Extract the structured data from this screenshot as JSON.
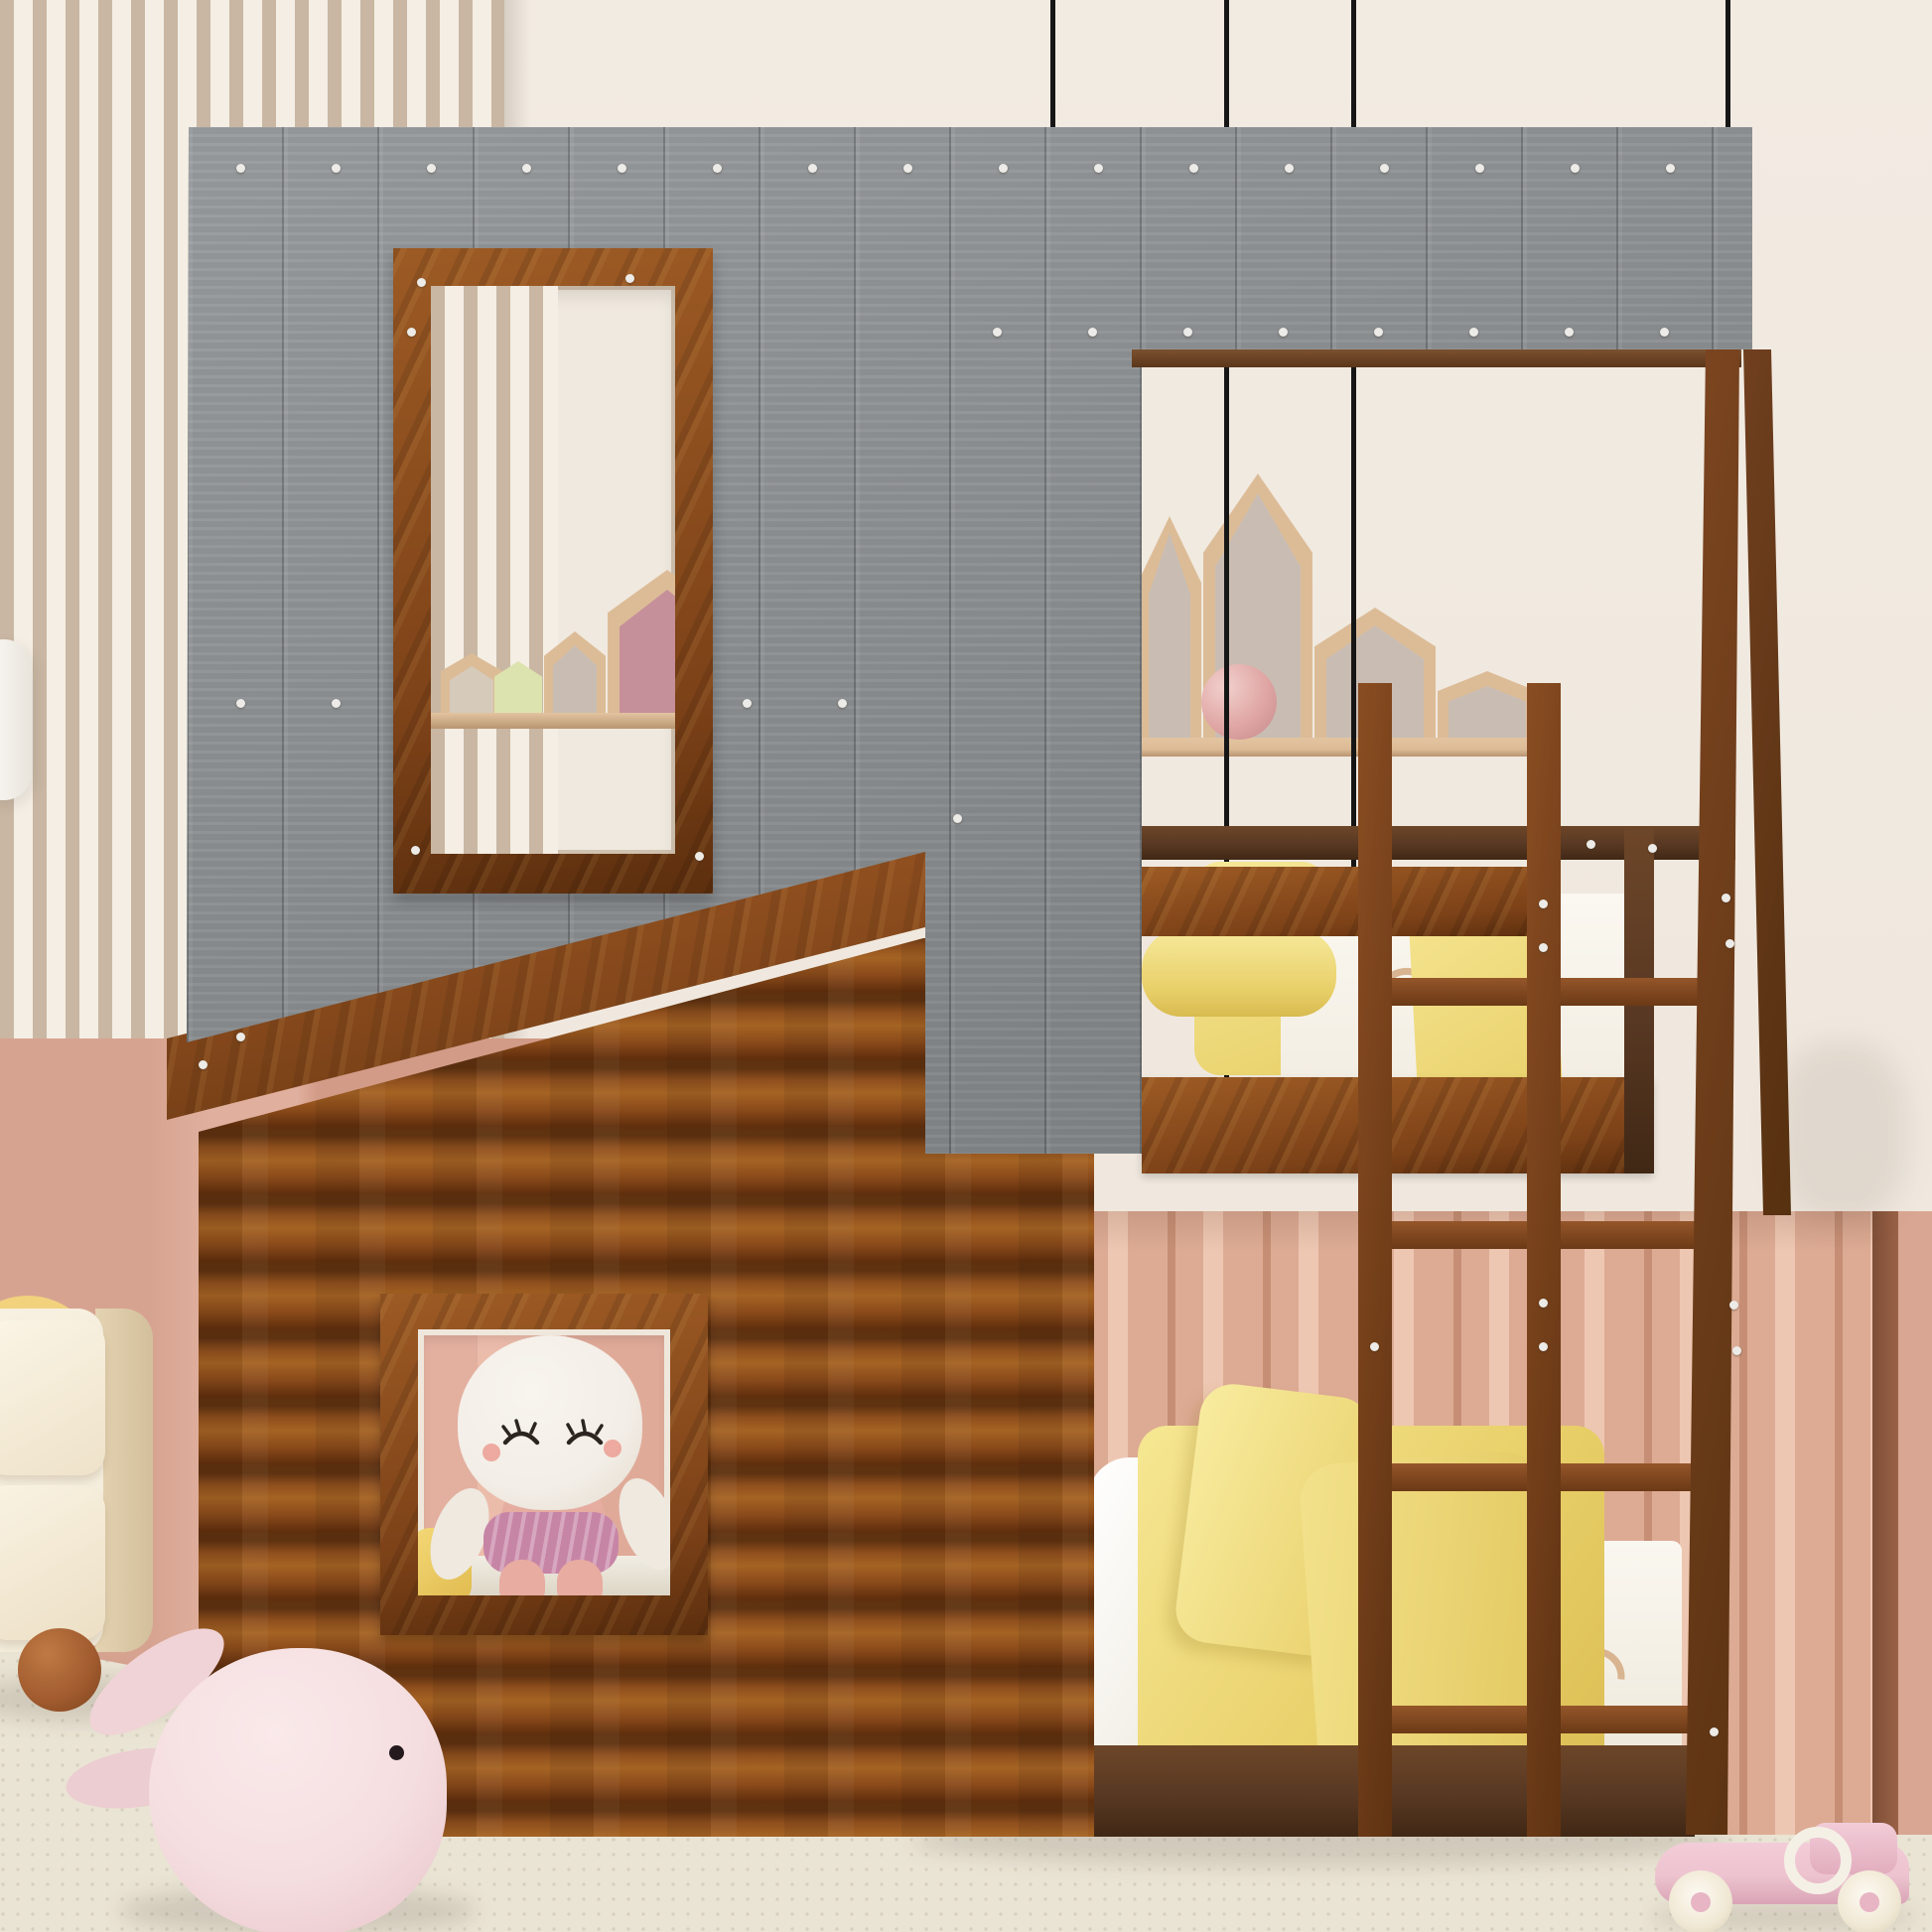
{
  "meta": {
    "description": "3D render product photo: kids twin-over-twin house bunk bed with gray plank roof, rustic log-cabin lower front, roof window, lower window with plush doll, ladder and A-frame post, in a pastel kids bedroom",
    "visible_text": ""
  },
  "palette": {
    "wall_cream": "#f0e9e0",
    "slat_tan": "#c9b7a3",
    "slat_cream": "#f4eee4",
    "pink_wall": "#d8a593",
    "wavy_light": "#eec7b2",
    "wavy_mid": "#ddab94",
    "wavy_dark": "#c68f75",
    "floor": "#eae4d4",
    "roof_gray": "#8b8f92",
    "rust": "#7d4218",
    "rust_light": "#9c5a24",
    "walnut": "#583823",
    "shelf_wood": "#dcbc97",
    "house_greige": "#c9bdb3",
    "house_rose": "#c6909a",
    "green_house": "#dde3ae",
    "bed_yellow": "#f1dc85",
    "sheet_white": "#f6f3ec",
    "cable": "#161616",
    "doll_white": "#f3eee7",
    "doll_pink": "#e9b2a7",
    "doll_skirt": "#c785a6",
    "ball_pink": "#e5b6b4",
    "whale_pink": "#f5dee0",
    "car_pink": "#edc3cf",
    "cream_furniture": "#f3ecdb",
    "foot_brown": "#a05a2e",
    "ring_yellow": "#f2d27d"
  },
  "objects": {
    "room": [
      "slatted accent wall",
      "cream wall",
      "salmon lower wall",
      "salmon accordion panel wall",
      "carpet floor",
      "four black hanging cables",
      "white pendant lamp edge"
    ],
    "bed": [
      "gray plank roof with window opening",
      "roof window frame",
      "log cabin front",
      "lower window with plush doll",
      "upper bunk with yellow pillows and white rainbow-print bedding",
      "lower bunk with white pillow and yellow blanket",
      "wooden ladder with four rungs",
      "A-frame corner posts",
      "white screw caps"
    ],
    "decor": [
      "house-shaped shelf houses",
      "pink ball",
      "small figurine",
      "cream nightstand with brown ball foot",
      "stacking-ring toy",
      "pink whale plush",
      "pink toy race car"
    ]
  }
}
